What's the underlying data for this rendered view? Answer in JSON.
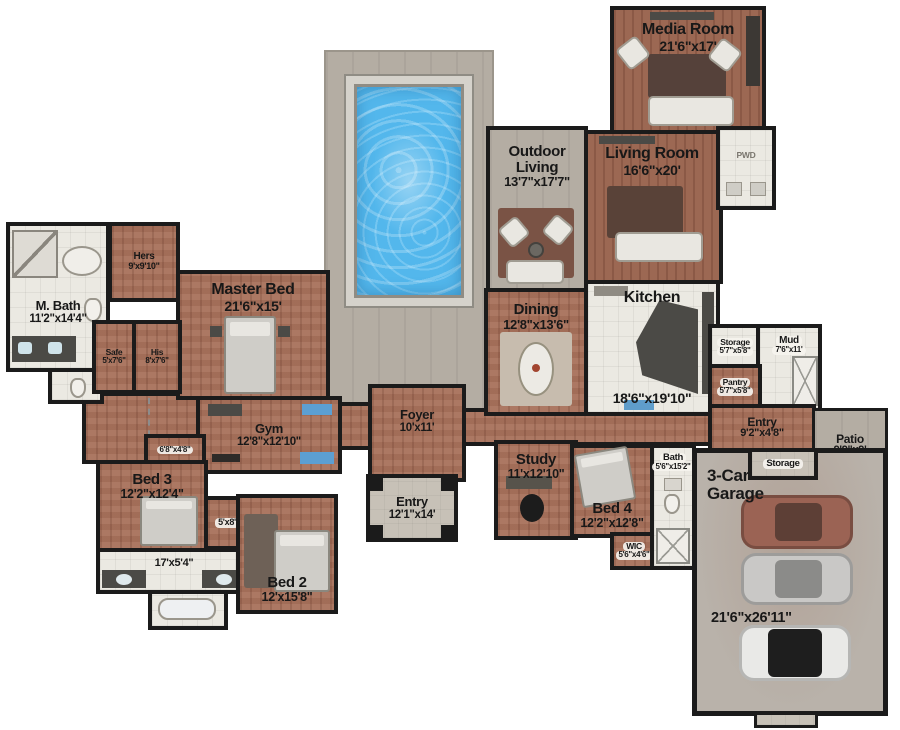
{
  "plan": {
    "type": "floor-plan",
    "rooms": {
      "media_room": {
        "name": "Media Room",
        "dims": "21'6\"x17'"
      },
      "living_room": {
        "name": "Living Room",
        "dims": "16'6\"x20'"
      },
      "outdoor_living": {
        "name": "Outdoor Living",
        "dims": "13'7\"x17'7\""
      },
      "kitchen": {
        "name": "Kitchen",
        "dims": "18'6\"x19'10\""
      },
      "dining": {
        "name": "Dining",
        "dims": "12'8\"x13'6\""
      },
      "pwd": {
        "name": "PWD"
      },
      "storage_mud": {
        "name": "Storage",
        "dims": "5'7\"x5'8\""
      },
      "mud": {
        "name": "Mud",
        "dims": "7'6\"x11'"
      },
      "pantry": {
        "name": "Pantry",
        "dims": "5'7\"x5'8\""
      },
      "entry_rear": {
        "name": "Entry",
        "dims": "9'2\"x4'8\""
      },
      "patio": {
        "name": "Patio",
        "dims": "9'9\"x9'"
      },
      "storage_garage": {
        "name": "Storage"
      },
      "garage": {
        "name": "3-Car Garage",
        "dims": "21'6\"x26'11\""
      },
      "bath_hall": {
        "name": "Bath",
        "dims": "5'6\"x15'2\""
      },
      "study": {
        "name": "Study",
        "dims": "11'x12'10\""
      },
      "bed4": {
        "name": "Bed 4",
        "dims": "12'2\"x12'8\""
      },
      "wic": {
        "name": "WIC",
        "dims": "5'6\"x4'6\""
      },
      "foyer": {
        "name": "Foyer",
        "dims": "10'x11'"
      },
      "entry_front": {
        "name": "Entry",
        "dims": "12'1\"x14'"
      },
      "master_bed": {
        "name": "Master Bed",
        "dims": "21'6\"x15'"
      },
      "hers": {
        "name": "Hers",
        "dims": "9'x9'10\""
      },
      "his": {
        "name": "His",
        "dims": "8'x7'6\""
      },
      "safe": {
        "name": "Safe",
        "dims": "5'x7'6\""
      },
      "m_bath": {
        "name": "M. Bath",
        "dims": "11'2\"x14'4\""
      },
      "gym": {
        "name": "Gym",
        "dims": "12'8\"x12'10\""
      },
      "closet_gym": {
        "dims": "6'8\"x4'8\""
      },
      "bed3": {
        "name": "Bed 3",
        "dims": "12'2\"x12'4\""
      },
      "closet_bed3": {
        "dims": "5'x8'"
      },
      "bath_jj": {
        "dims": "17'x5'4\""
      },
      "bed2": {
        "name": "Bed 2",
        "dims": "12'x15'8\""
      }
    },
    "colors": {
      "wall": "#1b1b1b",
      "wood_floor": "#a8715b",
      "deck": "#b4ada3",
      "tile": "#ebe9e2",
      "garage_floor": "#b9b2aa",
      "pool_water": "#53b7ec",
      "island": "#4b4a46",
      "car_maroon": "#9b6354",
      "car_silver": "#c9c8c6",
      "car_white": "#e9e9e7"
    }
  }
}
